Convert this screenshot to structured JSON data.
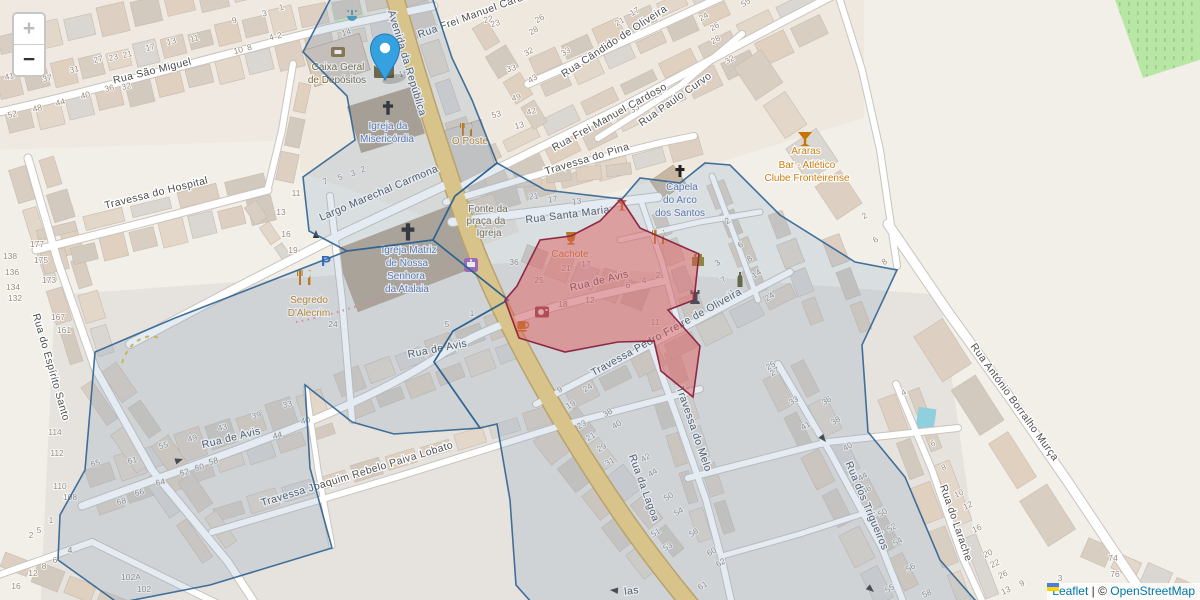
{
  "controls": {
    "zoom_in": "+",
    "zoom_out": "−"
  },
  "attribution": {
    "flag_icon": "ukraine-flag",
    "leaflet": "Leaflet",
    "separator": " | ",
    "copyright": "© ",
    "osm": "OpenStreetMap"
  },
  "map": {
    "colors": {
      "background": "#f2efe9",
      "road_main": "#f1cf7d",
      "road_main_casing": "#c8a45a",
      "road_white": "#ffffff",
      "road_casing": "#c9c4bd",
      "overlay_blue_stroke": "#2f6391",
      "overlay_blue_fill": "#7a9cc0",
      "overlay_red_stroke": "#8e2845",
      "overlay_red_fill": "#e05252",
      "marker_blue": "#36a1e0",
      "orchard_green": "#b7e6a5",
      "label_street": "#4e4e4e",
      "label_religious": "#5e6f9e",
      "label_amenity_orange": "#c97c10",
      "label_amenity_brown": "#7e6433",
      "housenumber": "#97897b"
    },
    "icons": {
      "parking_label": "P",
      "names": [
        "marker-pin-icon",
        "marker-shadow",
        "zoom-in-icon",
        "zoom-out-icon",
        "post-office-icon",
        "bank-icon",
        "church-cross-icon",
        "fountain-icon",
        "restaurant-icon",
        "bar-icon",
        "parking-icon",
        "shop-icon",
        "camera-icon",
        "cafe-icon",
        "castle-icon",
        "rook-icon",
        "bottle-icon",
        "oneway-arrow-icon",
        "pool",
        "ukraine-flag"
      ]
    },
    "street_labels": [
      [
        "Rua São Miguel",
        153,
        74,
        -14
      ],
      [
        "Avenida da República",
        404,
        64,
        73
      ],
      [
        "Rua Frei Manuel Cardoso",
        480,
        16,
        -20
      ],
      [
        "Rua Cândido de Oliveira",
        616,
        44,
        -33
      ],
      [
        "Rua Frei Manuel Cardoso",
        611,
        120,
        -29
      ],
      [
        "Rua Paulo Curvo",
        677,
        102,
        -35
      ],
      [
        "Travessa do Pina",
        588,
        162,
        -17
      ],
      [
        "Rua Santa Maria",
        568,
        218,
        -7
      ],
      [
        "Largo Marechal Carmona",
        380,
        196,
        -23
      ],
      [
        "Travessa do Hospital",
        157,
        196,
        -14
      ],
      [
        "Rua do Espírito Santo",
        48,
        368,
        74
      ],
      [
        "Rua do Espírito Santo",
        -26,
        182,
        74
      ],
      [
        "Rua de Avis",
        600,
        284,
        -14
      ],
      [
        "Rua de Avis",
        438,
        352,
        -11
      ],
      [
        "Rua de Avis",
        232,
        441,
        -14
      ],
      [
        "Travessa Pedro Freire de Oliveira",
        668,
        335,
        -29
      ],
      [
        "Travessa do Melo",
        691,
        430,
        71
      ],
      [
        "Rua da Lagoa",
        641,
        489,
        70
      ],
      [
        "Travessa Joaquim Rebelo Paiva Lobato",
        358,
        477,
        -17
      ],
      [
        "Rua António Borralho Murça",
        1012,
        404,
        54
      ],
      [
        "Rua dos Trigueiros",
        864,
        507,
        67
      ],
      [
        "Rua do Larache",
        953,
        524,
        71
      ],
      [
        "las",
        632,
        594,
        -8
      ]
    ],
    "poi_labels": [
      [
        "Caixa Geral",
        338,
        70,
        "brown"
      ],
      [
        "de Depósitos",
        337,
        83,
        "brown"
      ],
      [
        "Igreja da",
        388,
        129,
        "blue"
      ],
      [
        "Misericórdia",
        387,
        142,
        "blue"
      ],
      [
        "Igreja Matriz",
        409,
        253,
        "blue"
      ],
      [
        "de Nossa",
        407,
        266,
        "blue"
      ],
      [
        "Senhora",
        406,
        279,
        "blue"
      ],
      [
        "da Atalaia",
        407,
        292,
        "blue"
      ],
      [
        "Fonte da",
        488,
        212,
        "brown"
      ],
      [
        "praça da",
        486,
        224,
        "brown"
      ],
      [
        "Igreja",
        489,
        236,
        "brown"
      ],
      [
        "Capela",
        682,
        190,
        "blue"
      ],
      [
        "do Arco",
        680,
        203,
        "blue"
      ],
      [
        "dos Santos",
        680,
        216,
        "blue"
      ],
      [
        "Araras",
        806,
        154,
        "orange"
      ],
      [
        "Bar - Atlético",
        807,
        168,
        "orange"
      ],
      [
        "Clube Fronteirense",
        807,
        181,
        "orange"
      ],
      [
        "O Poste",
        470,
        144,
        "orange"
      ],
      [
        "Cachote",
        570,
        257,
        "orange"
      ],
      [
        "Segredo",
        309,
        303,
        "orange"
      ],
      [
        "D'Alecrim",
        309,
        316,
        "orange"
      ]
    ],
    "house_numbers": [
      [
        "41",
        10,
        79,
        -14
      ],
      [
        "37",
        48,
        81,
        -14
      ],
      [
        "31",
        75,
        72,
        -14
      ],
      [
        "27",
        99,
        62,
        -14
      ],
      [
        "23",
        114,
        60,
        -14
      ],
      [
        "21",
        128,
        57,
        -14
      ],
      [
        "17",
        151,
        50,
        -14
      ],
      [
        "13",
        172,
        44,
        -14
      ],
      [
        "11",
        195,
        41,
        -14
      ],
      [
        "9",
        235,
        23,
        -14
      ],
      [
        "3",
        265,
        16,
        -14
      ],
      [
        "1",
        282,
        10,
        -14
      ],
      [
        "10",
        239,
        53,
        -14
      ],
      [
        "8",
        250,
        50,
        -14
      ],
      [
        "4",
        272,
        40,
        -14
      ],
      [
        "2",
        280,
        38,
        -14
      ],
      [
        "52",
        13,
        117,
        -14
      ],
      [
        "48",
        38,
        111,
        -14
      ],
      [
        "44",
        61,
        105,
        -14
      ],
      [
        "40",
        86,
        98,
        -14
      ],
      [
        "36",
        110,
        91,
        -14
      ],
      [
        "32",
        127,
        89,
        -14
      ],
      [
        "14",
        347,
        35,
        -15
      ],
      [
        "16",
        404,
        76,
        -15
      ],
      [
        "22",
        489,
        22,
        -15
      ],
      [
        "23",
        496,
        26,
        -15
      ],
      [
        "33",
        512,
        71,
        -15
      ],
      [
        "49",
        517,
        100,
        -15
      ],
      [
        "53",
        497,
        117,
        -15
      ],
      [
        "42",
        532,
        114,
        -15
      ],
      [
        "13",
        520,
        128,
        -15
      ],
      [
        "17",
        636,
        14,
        -30
      ],
      [
        "21",
        621,
        24,
        -30
      ],
      [
        "26",
        541,
        21,
        -30
      ],
      [
        "28",
        535,
        33,
        -30
      ],
      [
        "32",
        530,
        54,
        -30
      ],
      [
        "33",
        567,
        54,
        -30
      ],
      [
        "43",
        534,
        81,
        -30
      ],
      [
        "24",
        705,
        19,
        -30
      ],
      [
        "26",
        716,
        29,
        -30
      ],
      [
        "28",
        717,
        42,
        -30
      ],
      [
        "32",
        731,
        62,
        -30
      ],
      [
        "55",
        747,
        5,
        -30
      ],
      [
        "25",
        659,
        96,
        -30
      ],
      [
        "35",
        636,
        111,
        -30
      ],
      [
        "7",
        326,
        184,
        -20
      ],
      [
        "5",
        341,
        180,
        -20
      ],
      [
        "3",
        354,
        176,
        -20
      ],
      [
        "2",
        364,
        172,
        -20
      ],
      [
        "11",
        296,
        196,
        0
      ],
      [
        "13",
        281,
        215,
        0
      ],
      [
        "16",
        286,
        237,
        0
      ],
      [
        "19",
        293,
        253,
        0
      ],
      [
        "24",
        333,
        327,
        0
      ],
      [
        "36",
        514,
        265,
        0
      ],
      [
        "1",
        472,
        316,
        0
      ],
      [
        "5",
        447,
        327,
        0
      ],
      [
        "177",
        37,
        247,
        0
      ],
      [
        "175",
        41,
        263,
        0
      ],
      [
        "173",
        49,
        283,
        0
      ],
      [
        "167",
        58,
        320,
        0
      ],
      [
        "161",
        64,
        333,
        0
      ],
      [
        "138",
        10,
        259,
        0
      ],
      [
        "136",
        12,
        275,
        0
      ],
      [
        "134",
        13,
        290,
        0
      ],
      [
        "132",
        15,
        301,
        0
      ],
      [
        "114",
        55,
        435,
        0
      ],
      [
        "112",
        57,
        456,
        0
      ],
      [
        "110",
        60,
        489,
        0
      ],
      [
        "108",
        70,
        500,
        0
      ],
      [
        "21",
        534,
        199,
        -7
      ],
      [
        "17",
        553,
        202,
        -7
      ],
      [
        "13",
        577,
        204,
        -7
      ],
      [
        "25",
        539,
        283,
        0
      ],
      [
        "21",
        566,
        271,
        0
      ],
      [
        "17",
        586,
        267,
        0
      ],
      [
        "12",
        590,
        303,
        0
      ],
      [
        "18",
        563,
        307,
        0
      ],
      [
        "6",
        628,
        288,
        0
      ],
      [
        "4",
        644,
        283,
        0
      ],
      [
        "2",
        658,
        278,
        0
      ],
      [
        "11",
        655,
        325,
        0
      ],
      [
        "2",
        729,
        223,
        -35
      ],
      [
        "6",
        742,
        247,
        -35
      ],
      [
        "8",
        751,
        261,
        -35
      ],
      [
        "14",
        758,
        276,
        -35
      ],
      [
        "3",
        719,
        265,
        -35
      ],
      [
        "7",
        725,
        282,
        -35
      ],
      [
        "11",
        732,
        296,
        -35
      ],
      [
        "24",
        771,
        299,
        -35
      ],
      [
        "2",
        866,
        218,
        -35
      ],
      [
        "6",
        877,
        242,
        -35
      ],
      [
        "8",
        886,
        264,
        -35
      ],
      [
        "65",
        96,
        466,
        -13
      ],
      [
        "61",
        133,
        463,
        -13
      ],
      [
        "55",
        164,
        448,
        -13
      ],
      [
        "49",
        193,
        441,
        -13
      ],
      [
        "43",
        223,
        430,
        -13
      ],
      [
        "39",
        257,
        418,
        -13
      ],
      [
        "33",
        288,
        407,
        -13
      ],
      [
        "44",
        278,
        438,
        -13
      ],
      [
        "40",
        306,
        423,
        -13
      ],
      [
        "58",
        214,
        464,
        -13
      ],
      [
        "60",
        200,
        470,
        -13
      ],
      [
        "62",
        185,
        475,
        -13
      ],
      [
        "64",
        161,
        485,
        -13
      ],
      [
        "66",
        140,
        495,
        -13
      ],
      [
        "68",
        122,
        504,
        -13
      ],
      [
        "1",
        51,
        523,
        0
      ],
      [
        "2",
        31,
        538,
        0
      ],
      [
        "5",
        39,
        533,
        0
      ],
      [
        "4",
        70,
        553,
        0
      ],
      [
        "6",
        55,
        563,
        0
      ],
      [
        "8",
        44,
        569,
        0
      ],
      [
        "12",
        33,
        576,
        0
      ],
      [
        "16",
        16,
        589,
        0
      ],
      [
        "102A",
        131,
        580,
        0
      ],
      [
        "102",
        144,
        592,
        0
      ],
      [
        "9",
        561,
        392,
        -30
      ],
      [
        "24",
        589,
        390,
        -30
      ],
      [
        "23",
        583,
        427,
        -30
      ],
      [
        "21",
        592,
        439,
        -30
      ],
      [
        "29",
        603,
        450,
        -30
      ],
      [
        "31",
        611,
        464,
        -30
      ],
      [
        "38",
        609,
        415,
        -30
      ],
      [
        "40",
        618,
        427,
        -30
      ],
      [
        "42",
        647,
        460,
        -30
      ],
      [
        "44",
        654,
        475,
        -30
      ],
      [
        "50",
        670,
        499,
        -30
      ],
      [
        "54",
        680,
        514,
        -30
      ],
      [
        "51",
        657,
        535,
        -30
      ],
      [
        "53",
        669,
        549,
        -30
      ],
      [
        "58",
        695,
        535,
        -30
      ],
      [
        "60",
        713,
        554,
        -30
      ],
      [
        "62",
        722,
        565,
        -30
      ],
      [
        "61",
        704,
        588,
        -30
      ],
      [
        "19",
        572,
        407,
        -30
      ],
      [
        "25",
        772,
        368,
        -30
      ],
      [
        "27",
        776,
        374,
        -30
      ],
      [
        "33",
        795,
        403,
        -30
      ],
      [
        "36",
        828,
        403,
        -30
      ],
      [
        "41",
        807,
        428,
        -30
      ],
      [
        "38",
        837,
        423,
        -30
      ],
      [
        "40",
        849,
        449,
        -30
      ],
      [
        "44",
        864,
        479,
        -30
      ],
      [
        "46",
        868,
        492,
        -30
      ],
      [
        "50",
        884,
        515,
        -30
      ],
      [
        "52",
        893,
        530,
        -30
      ],
      [
        "54",
        899,
        544,
        -30
      ],
      [
        "56",
        912,
        570,
        -30
      ],
      [
        "55",
        891,
        591,
        -30
      ],
      [
        "4",
        905,
        395,
        -30
      ],
      [
        "6",
        934,
        446,
        -25
      ],
      [
        "8",
        945,
        470,
        -25
      ],
      [
        "10",
        960,
        496,
        -25
      ],
      [
        "12",
        969,
        508,
        -25
      ],
      [
        "16",
        978,
        531,
        -25
      ],
      [
        "20",
        989,
        556,
        -25
      ],
      [
        "22",
        996,
        566,
        -25
      ],
      [
        "26",
        1004,
        577,
        -25
      ],
      [
        "9",
        1023,
        586,
        -25
      ],
      [
        "3",
        1060,
        581,
        0
      ],
      [
        "13",
        1007,
        593,
        -25
      ],
      [
        "74",
        1113,
        561,
        0
      ],
      [
        "76",
        1115,
        577,
        0
      ],
      [
        "58",
        928,
        596,
        -25
      ]
    ]
  }
}
